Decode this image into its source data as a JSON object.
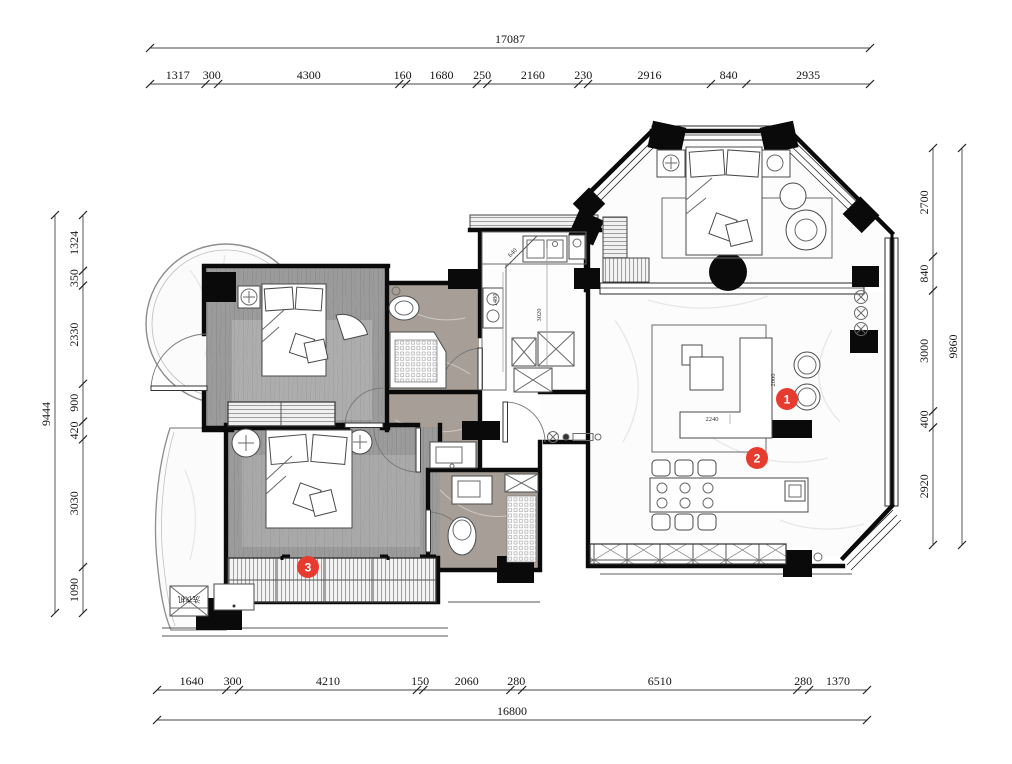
{
  "drawing": {
    "type": "apartment-floor-plan",
    "units": "mm"
  },
  "dims": {
    "top": {
      "total": "17087",
      "segments": [
        "1317",
        "300",
        "4300",
        "160",
        "1680",
        "250",
        "2160",
        "230",
        "2916",
        "840",
        "2935"
      ]
    },
    "bottom": {
      "total": "16800",
      "segments": [
        "1640",
        "300",
        "4210",
        "150",
        "2060",
        "280",
        "6510",
        "280",
        "1370"
      ]
    },
    "left": {
      "total": "9444",
      "segments": [
        "1324",
        "350",
        "2330",
        "900",
        "420",
        "3030",
        "1090"
      ]
    },
    "right": {
      "total": "9860",
      "segments": [
        "2700",
        "840",
        "3000",
        "400",
        "2920"
      ]
    }
  },
  "interior_dims": {
    "sofa_width": "2240",
    "sofa_depth": "2000",
    "kitchen_run": "3020",
    "counter": "1480",
    "splay": "640"
  },
  "markers": [
    {
      "id": "1"
    },
    {
      "id": "2"
    },
    {
      "id": "3"
    }
  ],
  "labels": {
    "washer": "洗衣机"
  },
  "colors": {
    "marker_red": "#e83b2f",
    "wall_black": "#0a0a0a",
    "wood_gray": "#9b9b9b",
    "stone_gray": "#a79f97",
    "paper": "#ffffff"
  }
}
